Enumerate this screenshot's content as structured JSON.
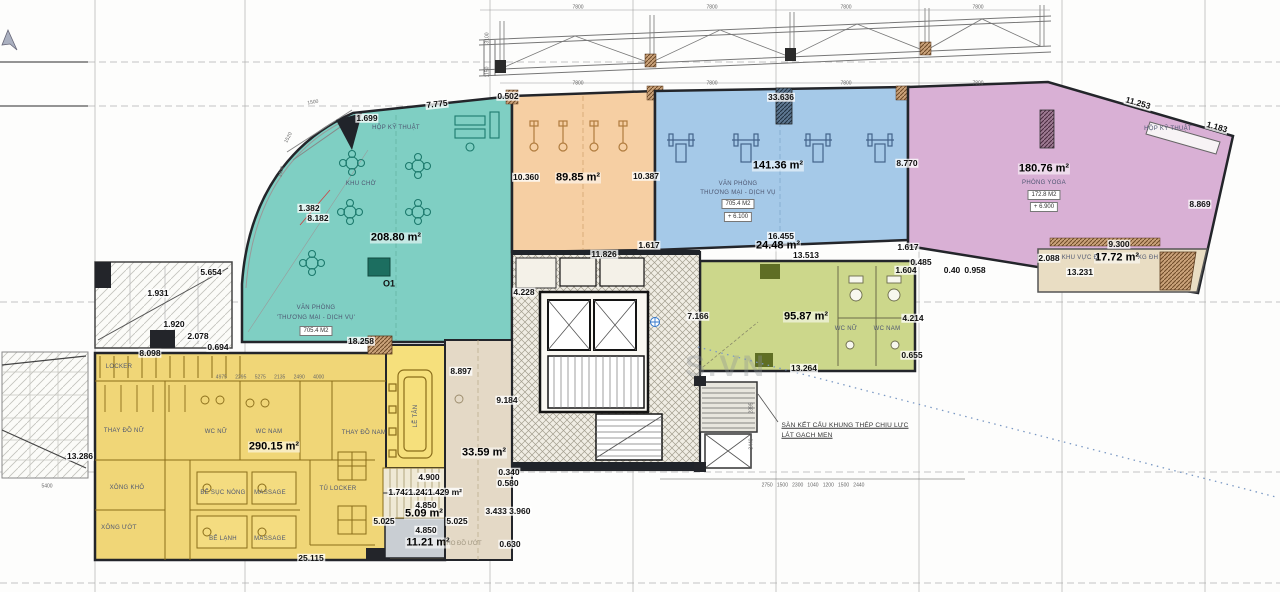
{
  "drawing": {
    "type": "architectural-floor-plan",
    "note": [
      "SÀN KẾT CẤU KHUNG THÉP CHỊU LỰC",
      "LÁT GẠCH MEN"
    ],
    "watermark": "S.VN",
    "zones": [
      {
        "label": "KHU CHỜ / VĂN PHÒNG 'THƯƠNG MẠI - DỊCH VỤ'",
        "area": "208.80 m²",
        "tag": "705.4 M2",
        "mark": "O1",
        "color": "#7fcfc3"
      },
      {
        "area": "89.85 m²",
        "color": "#f6cfa3"
      },
      {
        "label": "VĂN PHÒNG THƯƠNG MẠI - DỊCH VỤ",
        "area": "141.36 m²",
        "tag": "705.4 M2",
        "level": "+ 6.100",
        "color": "#a5c9e8"
      },
      {
        "label": "PHÒNG YOGA",
        "area": "180.76 m²",
        "tag": "172.8 M2",
        "level": "+ 6.900",
        "color": "#d9b0d5"
      },
      {
        "label": "WC NỮ / WC NAM",
        "area": "95.87 m²",
        "color": "#ccd78b"
      },
      {
        "label": "LOCKER / MASSAGE / XÔNG",
        "area": "290.15 m²",
        "color": "#f0d677"
      },
      {
        "area": "33.59 m²",
        "color": "#e4d9c6"
      },
      {
        "area": "24.48 m²",
        "color": "#ffffff"
      },
      {
        "label": "KHU VỰC Đ / XG ĐH",
        "area": "17.72 m²",
        "color": "#e9ddc3"
      },
      {
        "area": "11.21 m²",
        "color": "#c9ced3"
      },
      {
        "area": "5.09 m²",
        "color": "#efe9d5"
      }
    ]
  },
  "labels": [
    {
      "t": "7.775",
      "x": 437,
      "y": 104,
      "r": -6
    },
    {
      "t": "1.699",
      "x": 367,
      "y": 118
    },
    {
      "t": "0.502",
      "x": 508,
      "y": 96
    },
    {
      "t": "33.636",
      "x": 781,
      "y": 97
    },
    {
      "t": "11.253",
      "x": 1138,
      "y": 103,
      "r": 16
    },
    {
      "t": "1.183",
      "x": 1217,
      "y": 127,
      "r": 16
    },
    {
      "t": "1.382",
      "x": 309,
      "y": 208
    },
    {
      "t": "8.182",
      "x": 318,
      "y": 218
    },
    {
      "t": "10.360",
      "x": 526,
      "y": 177
    },
    {
      "t": "10.387",
      "x": 646,
      "y": 176
    },
    {
      "t": "8.770",
      "x": 907,
      "y": 163
    },
    {
      "t": "8.869",
      "x": 1200,
      "y": 204
    },
    {
      "t": "5.654",
      "x": 211,
      "y": 272
    },
    {
      "t": "1.931",
      "x": 158,
      "y": 293
    },
    {
      "t": "1.920",
      "x": 174,
      "y": 324
    },
    {
      "t": "2.078",
      "x": 198,
      "y": 336
    },
    {
      "t": "0.694",
      "x": 218,
      "y": 347
    },
    {
      "t": "8.098",
      "x": 150,
      "y": 353
    },
    {
      "t": "18.258",
      "x": 361,
      "y": 341
    },
    {
      "t": "11.826",
      "x": 604,
      "y": 254
    },
    {
      "t": "1.617",
      "x": 649,
      "y": 245
    },
    {
      "t": "16.455",
      "x": 781,
      "y": 236
    },
    {
      "t": "13.513",
      "x": 806,
      "y": 255
    },
    {
      "t": "1.617",
      "x": 908,
      "y": 247
    },
    {
      "t": "9.300",
      "x": 1119,
      "y": 244
    },
    {
      "t": "2.088",
      "x": 1049,
      "y": 258
    },
    {
      "t": "13.231",
      "x": 1080,
      "y": 272
    },
    {
      "t": "0.485",
      "x": 921,
      "y": 262
    },
    {
      "t": "1.604",
      "x": 906,
      "y": 270
    },
    {
      "t": "0.40",
      "x": 952,
      "y": 270
    },
    {
      "t": "0.958",
      "x": 975,
      "y": 270
    },
    {
      "t": "7.166",
      "x": 698,
      "y": 316
    },
    {
      "t": "4.214",
      "x": 913,
      "y": 318
    },
    {
      "t": "0.655",
      "x": 912,
      "y": 355
    },
    {
      "t": "13.264",
      "x": 804,
      "y": 368
    },
    {
      "t": "4.228",
      "x": 524,
      "y": 292
    },
    {
      "t": "8.897",
      "x": 461,
      "y": 371
    },
    {
      "t": "9.184",
      "x": 507,
      "y": 400
    },
    {
      "t": "13.286",
      "x": 80,
      "y": 456
    },
    {
      "t": "0.340",
      "x": 509,
      "y": 472
    },
    {
      "t": "0.580",
      "x": 508,
      "y": 483
    },
    {
      "t": "3.433 3.960",
      "x": 508,
      "y": 511
    },
    {
      "t": "0.630",
      "x": 510,
      "y": 544
    },
    {
      "t": "4.900",
      "x": 429,
      "y": 477
    },
    {
      "t": "1.742",
      "x": 399,
      "y": 492
    },
    {
      "t": "1.242",
      "x": 419,
      "y": 492
    },
    {
      "t": "1.429 m²",
      "x": 445,
      "y": 492
    },
    {
      "t": "4.850",
      "x": 426,
      "y": 505
    },
    {
      "t": "5.025",
      "x": 384,
      "y": 521
    },
    {
      "t": "5.025",
      "x": 457,
      "y": 521
    },
    {
      "t": "4.850",
      "x": 426,
      "y": 530
    },
    {
      "t": "25.115",
      "x": 311,
      "y": 558
    },
    {
      "t": "208.80 m²",
      "x": 396,
      "y": 238,
      "s": "area"
    },
    {
      "t": "89.85 m²",
      "x": 578,
      "y": 178,
      "s": "area"
    },
    {
      "t": "141.36 m²",
      "x": 778,
      "y": 166,
      "s": "area"
    },
    {
      "t": "180.76 m²",
      "x": 1044,
      "y": 169,
      "s": "area"
    },
    {
      "t": "24.48 m²",
      "x": 778,
      "y": 246,
      "s": "area"
    },
    {
      "t": "95.87 m²",
      "x": 806,
      "y": 317,
      "s": "area"
    },
    {
      "t": "290.15 m²",
      "x": 274,
      "y": 447,
      "s": "area"
    },
    {
      "t": "33.59 m²",
      "x": 484,
      "y": 453,
      "s": "area"
    },
    {
      "t": "17.72 m²",
      "x": 1117,
      "y": 258,
      "s": "area"
    },
    {
      "t": "5.09 m²",
      "x": 424,
      "y": 514,
      "s": "area"
    },
    {
      "t": "11.21 m²",
      "x": 428,
      "y": 543,
      "s": "area"
    },
    {
      "t": "HỘP KỸ THUẬT",
      "x": 396,
      "y": 128,
      "s": "room"
    },
    {
      "t": "KHU CHỜ",
      "x": 361,
      "y": 184,
      "s": "room"
    },
    {
      "t": "VĂN PHÒNG",
      "x": 316,
      "y": 308,
      "s": "room"
    },
    {
      "t": "'THƯƠNG MẠI - DỊCH VỤ'",
      "x": 316,
      "y": 318,
      "s": "room"
    },
    {
      "t": "VĂN PHÒNG",
      "x": 738,
      "y": 184,
      "s": "room"
    },
    {
      "t": "THƯƠNG MẠI - DỊCH VỤ",
      "x": 738,
      "y": 193,
      "s": "room"
    },
    {
      "t": "PHÒNG YOGA",
      "x": 1044,
      "y": 183,
      "s": "room"
    },
    {
      "t": "HỘP KỸ THUẬT",
      "x": 1168,
      "y": 129,
      "s": "room"
    },
    {
      "t": "KHU VỰC Đ",
      "x": 1080,
      "y": 258,
      "s": "room"
    },
    {
      "t": "XG ĐH",
      "x": 1148,
      "y": 258,
      "s": "room"
    },
    {
      "t": "WC NỮ",
      "x": 846,
      "y": 329,
      "s": "room"
    },
    {
      "t": "WC NAM",
      "x": 887,
      "y": 329,
      "s": "room"
    },
    {
      "t": "LOCKER",
      "x": 119,
      "y": 367,
      "s": "room"
    },
    {
      "t": "THAY ĐỒ NỮ",
      "x": 124,
      "y": 431,
      "s": "room"
    },
    {
      "t": "WC NỮ",
      "x": 216,
      "y": 432,
      "s": "room"
    },
    {
      "t": "WC NAM",
      "x": 269,
      "y": 432,
      "s": "room"
    },
    {
      "t": "THAY ĐỒ NAM",
      "x": 364,
      "y": 433,
      "s": "room"
    },
    {
      "t": "XÔNG KHÔ",
      "x": 127,
      "y": 488,
      "s": "room"
    },
    {
      "t": "XÔNG ƯỚT",
      "x": 119,
      "y": 528,
      "s": "room"
    },
    {
      "t": "BỂ SỤC NÓNG",
      "x": 223,
      "y": 493,
      "s": "room"
    },
    {
      "t": "MASSAGE",
      "x": 270,
      "y": 493,
      "s": "room"
    },
    {
      "t": "BỂ LẠNH",
      "x": 223,
      "y": 539,
      "s": "room"
    },
    {
      "t": "MASSAGE",
      "x": 270,
      "y": 539,
      "s": "room"
    },
    {
      "t": "TỦ LOCKER",
      "x": 338,
      "y": 489,
      "s": "room"
    },
    {
      "t": "LỄ TÂN",
      "x": 416,
      "y": 416,
      "s": "room",
      "r": -90
    },
    {
      "t": "KHO ĐỒ ƯỚT",
      "x": 462,
      "y": 544,
      "s": "roomfaint"
    },
    {
      "t": "O1",
      "x": 389,
      "y": 284,
      "s": "mark"
    },
    {
      "t": "705.4 M2",
      "x": 316,
      "y": 331,
      "s": "box"
    },
    {
      "t": "705.4 M2",
      "x": 738,
      "y": 204,
      "s": "box"
    },
    {
      "t": "+ 6.100",
      "x": 738,
      "y": 217,
      "s": "box"
    },
    {
      "t": "172.8 M2",
      "x": 1044,
      "y": 195,
      "s": "box"
    },
    {
      "t": "+ 6.900",
      "x": 1044,
      "y": 207,
      "s": "box"
    },
    {
      "t": "SÀN KẾT CẤU KHUNG THÉP CHỊU LỰC",
      "x": 845,
      "y": 426,
      "s": "note"
    },
    {
      "t": "LÁT GẠCH MEN",
      "x": 807,
      "y": 436,
      "s": "note"
    },
    {
      "t": "7800",
      "x": 578,
      "y": 84,
      "s": "micro"
    },
    {
      "t": "7800",
      "x": 712,
      "y": 84,
      "s": "micro"
    },
    {
      "t": "7800",
      "x": 846,
      "y": 84,
      "s": "micro"
    },
    {
      "t": "7800",
      "x": 978,
      "y": 84,
      "s": "micro"
    },
    {
      "t": "7800",
      "x": 578,
      "y": 8,
      "s": "micro"
    },
    {
      "t": "7800",
      "x": 712,
      "y": 8,
      "s": "micro"
    },
    {
      "t": "7800",
      "x": 846,
      "y": 8,
      "s": "micro"
    },
    {
      "t": "7800",
      "x": 978,
      "y": 8,
      "s": "micro"
    },
    {
      "t": "3100",
      "x": 488,
      "y": 38,
      "s": "micro",
      "r": -90
    },
    {
      "t": "1150",
      "x": 488,
      "y": 72,
      "s": "micro",
      "r": -90
    },
    {
      "t": "2750   1500   2300   1040   1200   1500   2440",
      "x": 813,
      "y": 486,
      "s": "micro"
    },
    {
      "t": "4975      2295      5275      2135      2490      4000",
      "x": 270,
      "y": 378,
      "s": "micro"
    },
    {
      "t": "5400",
      "x": 47,
      "y": 487,
      "s": "micro"
    },
    {
      "t": "2395",
      "x": 752,
      "y": 408,
      "s": "micro",
      "r": -90
    },
    {
      "t": "3440",
      "x": 752,
      "y": 444,
      "s": "micro",
      "r": -90
    },
    {
      "t": "1500",
      "x": 313,
      "y": 103,
      "s": "micro",
      "r": -10
    },
    {
      "t": "1520",
      "x": 289,
      "y": 138,
      "s": "micro",
      "r": -62
    },
    {
      "t": "1400",
      "x": 282,
      "y": 172,
      "s": "micro",
      "r": -75
    },
    {
      "t": "S.VN",
      "x": 726,
      "y": 367,
      "s": "wm"
    }
  ]
}
